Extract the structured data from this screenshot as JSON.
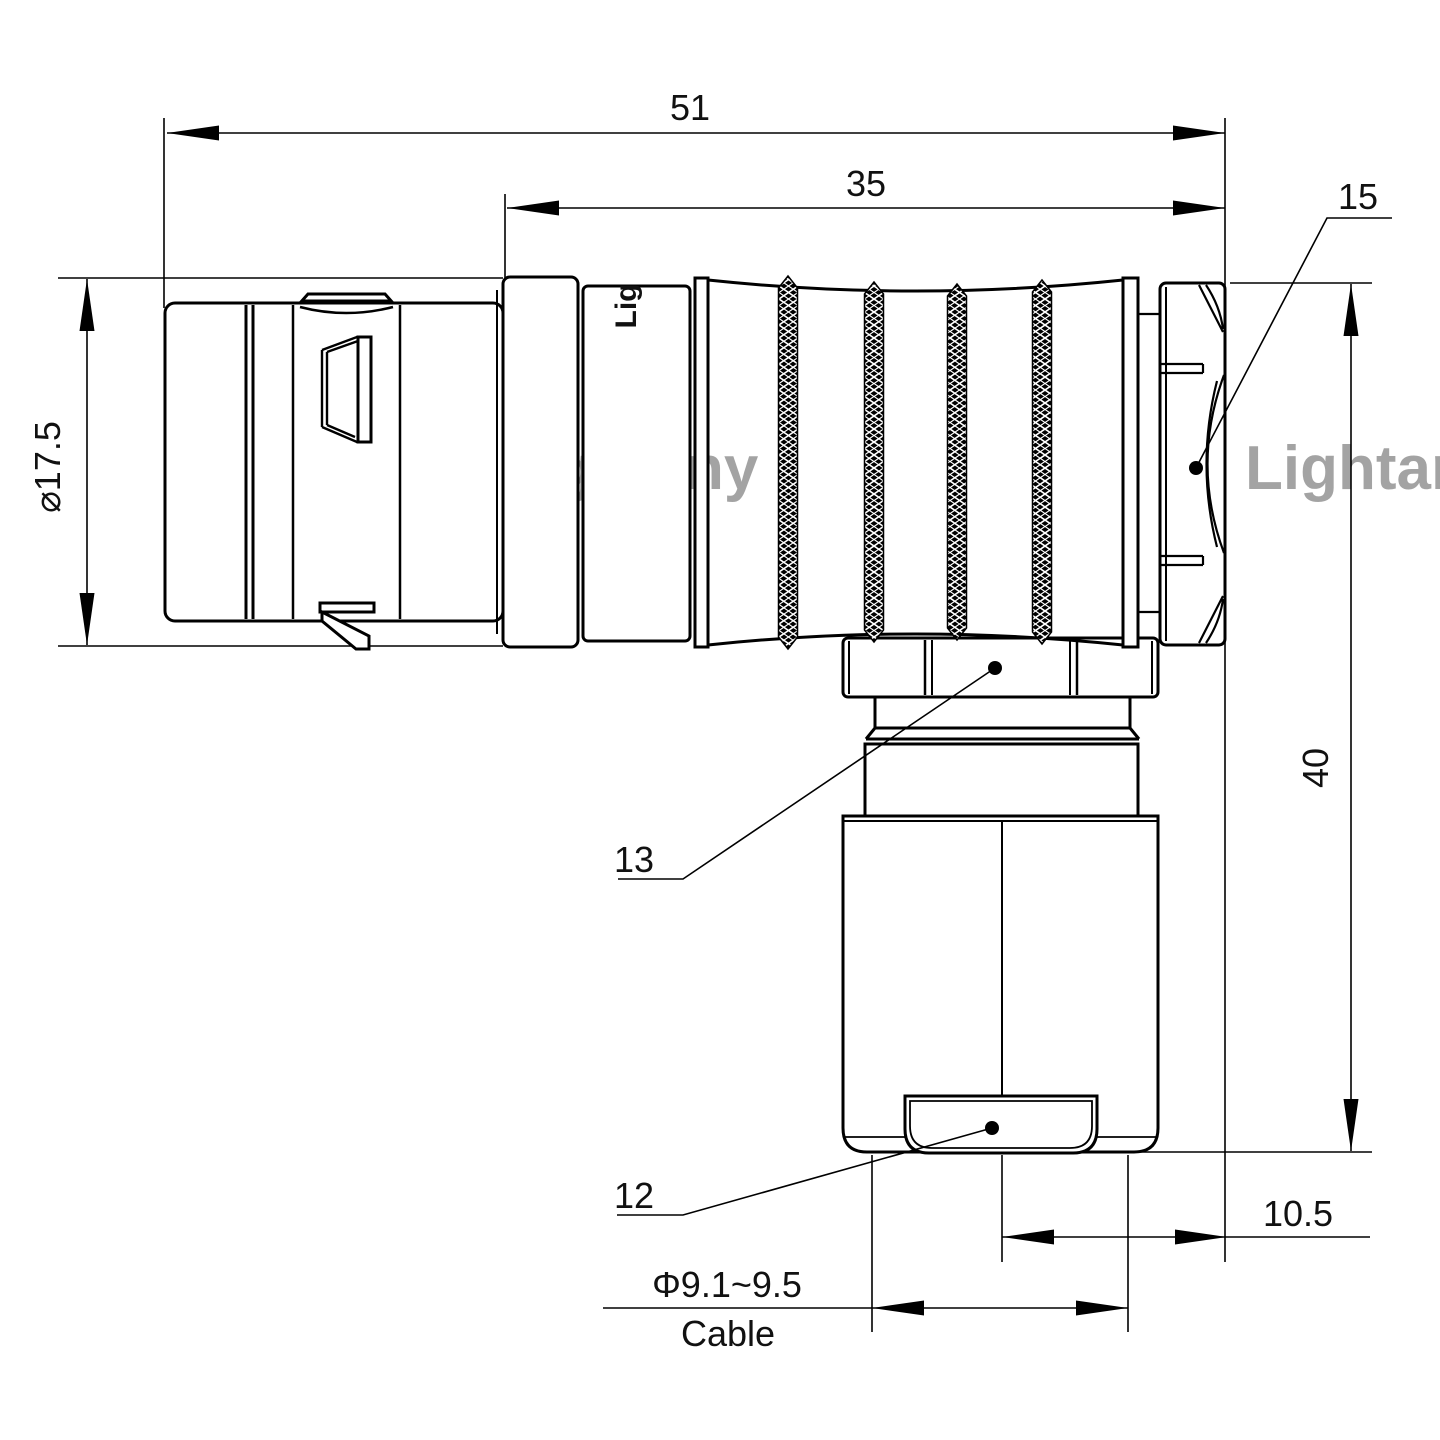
{
  "title": "Right-angle push-pull connector technical drawing",
  "colors": {
    "line": "#000000",
    "background": "#ffffff",
    "watermark": "#ee8888"
  },
  "watermark": {
    "text": "Lightany"
  },
  "brand": {
    "engraving": "Lig"
  },
  "dimensions": {
    "overall_length": "51",
    "rear_length": "35",
    "rear_nut_ref": "15",
    "front_diameter": "⌀17.5",
    "height": "40",
    "coupling_nut_ref": "13",
    "bushing_ref": "12",
    "rear_offset": "10.5",
    "cable_diameter": "Φ9.1~9.5",
    "cable_word": "Cable"
  }
}
